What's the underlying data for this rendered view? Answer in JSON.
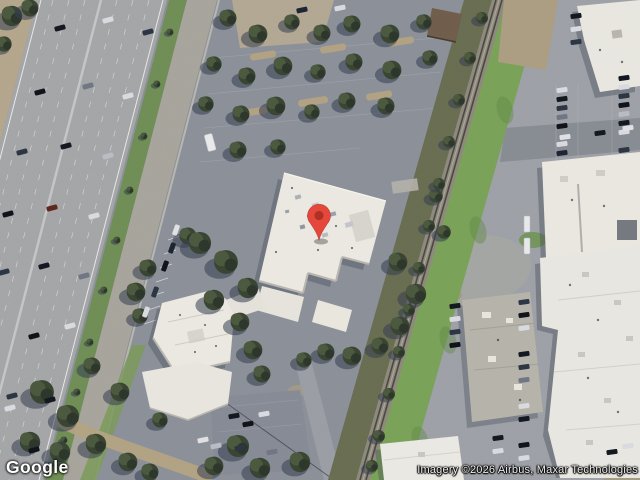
{
  "app": {
    "name": "Google Maps satellite imagery",
    "view_mode": "satellite"
  },
  "branding": {
    "logo_text": "Google"
  },
  "attribution": {
    "text": "Imagery ©2026 Airbus, Maxar Technologies"
  },
  "marker": {
    "label": "location-pin",
    "fill": "#E6473B",
    "core": "#AE3125",
    "outline": "#9E2B20",
    "x": 319,
    "y": 240
  },
  "scene": {
    "description": "Aerial view: multi-lane freeway with frontage road on the left, tree-dotted parking lot and white office building with red pin in the center, tree-lined railroad corridor with grass verge, and industrial buildings with parking lots on the right.",
    "features": [
      "freeway",
      "frontage-road",
      "center-parking-lot",
      "office-building",
      "railroad",
      "grass-verge",
      "industrial-buildings",
      "trees",
      "vehicles"
    ]
  }
}
